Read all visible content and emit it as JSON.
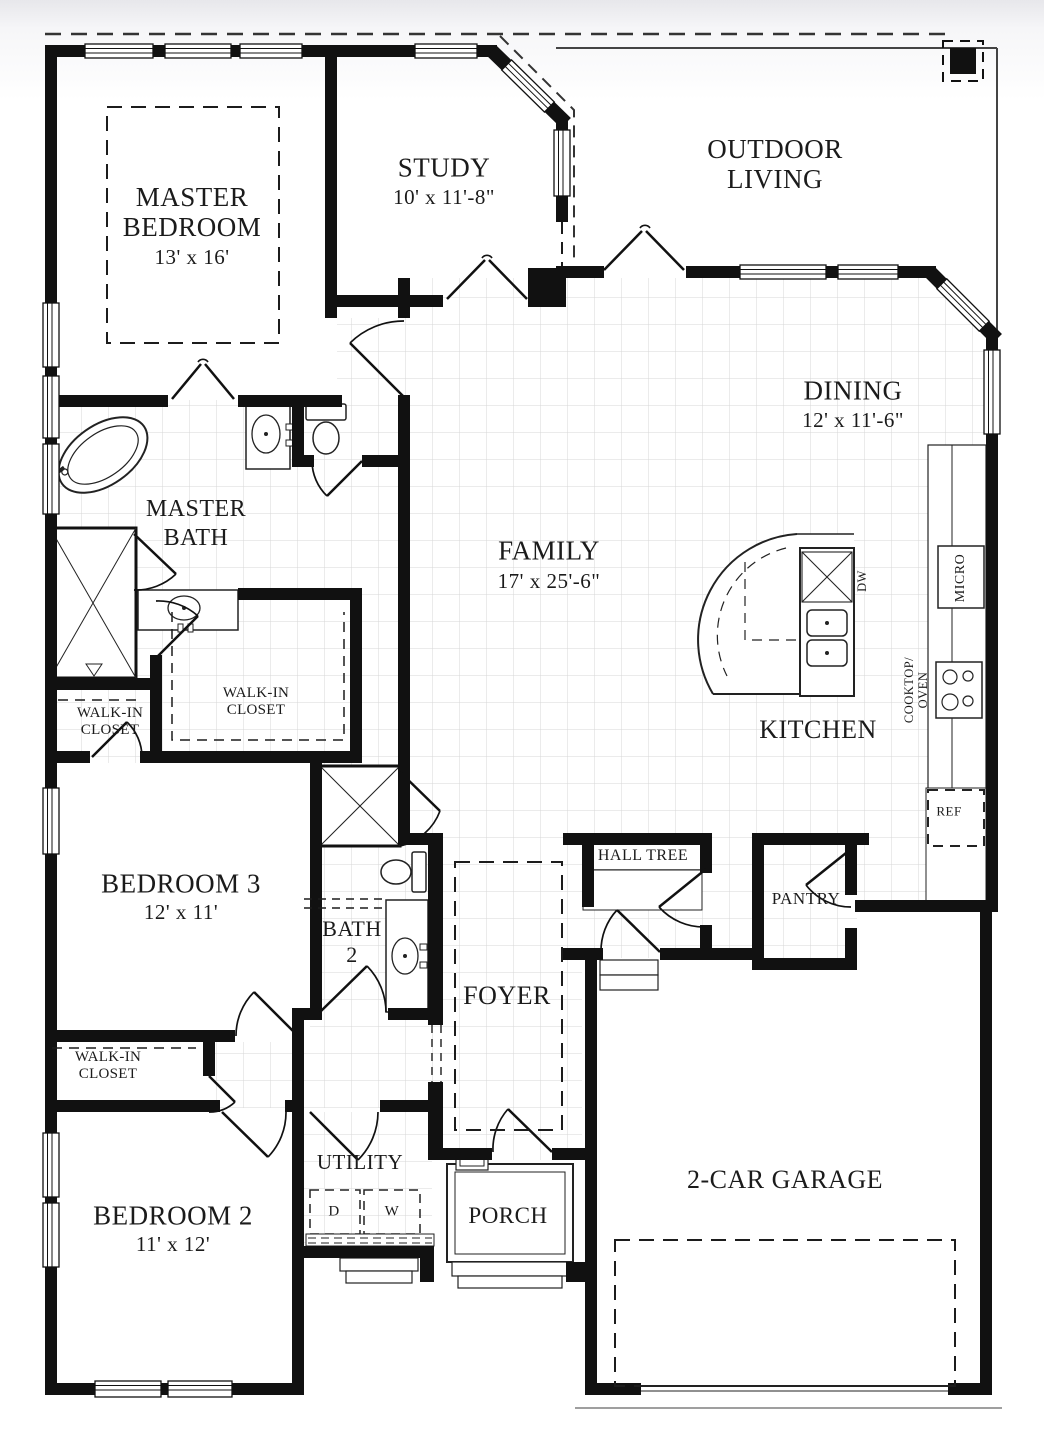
{
  "plan": {
    "rooms": {
      "master_bedroom": {
        "line1": "MASTER",
        "line2": "BEDROOM",
        "dims": "13' x 16'"
      },
      "study": {
        "name": "STUDY",
        "dims": "10' x 11'-8\""
      },
      "outdoor_living": {
        "line1": "OUTDOOR",
        "line2": "LIVING"
      },
      "dining": {
        "name": "DINING",
        "dims": "12' x 11'-6\""
      },
      "family": {
        "name": "FAMILY",
        "dims": "17' x 25'-6\""
      },
      "master_bath": {
        "line1": "MASTER",
        "line2": "BATH"
      },
      "master_closet": {
        "line1": "WALK-IN",
        "line2": "CLOSET"
      },
      "small_closet": {
        "line1": "WALK-IN",
        "line2": "CLOSET"
      },
      "kitchen": {
        "name": "KITCHEN"
      },
      "pantry": {
        "name": "PANTRY"
      },
      "hall_tree": {
        "name": "HALL TREE"
      },
      "bedroom3": {
        "name": "BEDROOM 3",
        "dims": "12' x 11'"
      },
      "bath2": {
        "line1": "BATH",
        "line2": "2"
      },
      "foyer": {
        "name": "FOYER"
      },
      "bedroom2_closet": {
        "line1": "WALK-IN",
        "line2": "CLOSET"
      },
      "bedroom2": {
        "name": "BEDROOM 2",
        "dims": "11' x 12'"
      },
      "utility": {
        "name": "UTILITY"
      },
      "porch": {
        "name": "PORCH"
      },
      "garage": {
        "name": "2-CAR GARAGE"
      }
    },
    "appliances": {
      "dw": "DW",
      "micro": "MICRO",
      "cooktop_line1": "COOKTOP/",
      "cooktop_line2": "OVEN",
      "ref": "REF",
      "dryer": "D",
      "washer": "W"
    }
  },
  "colors": {
    "wall": "#111111",
    "tile_line": "#d7d7d7",
    "text": "#1b1b1b"
  }
}
